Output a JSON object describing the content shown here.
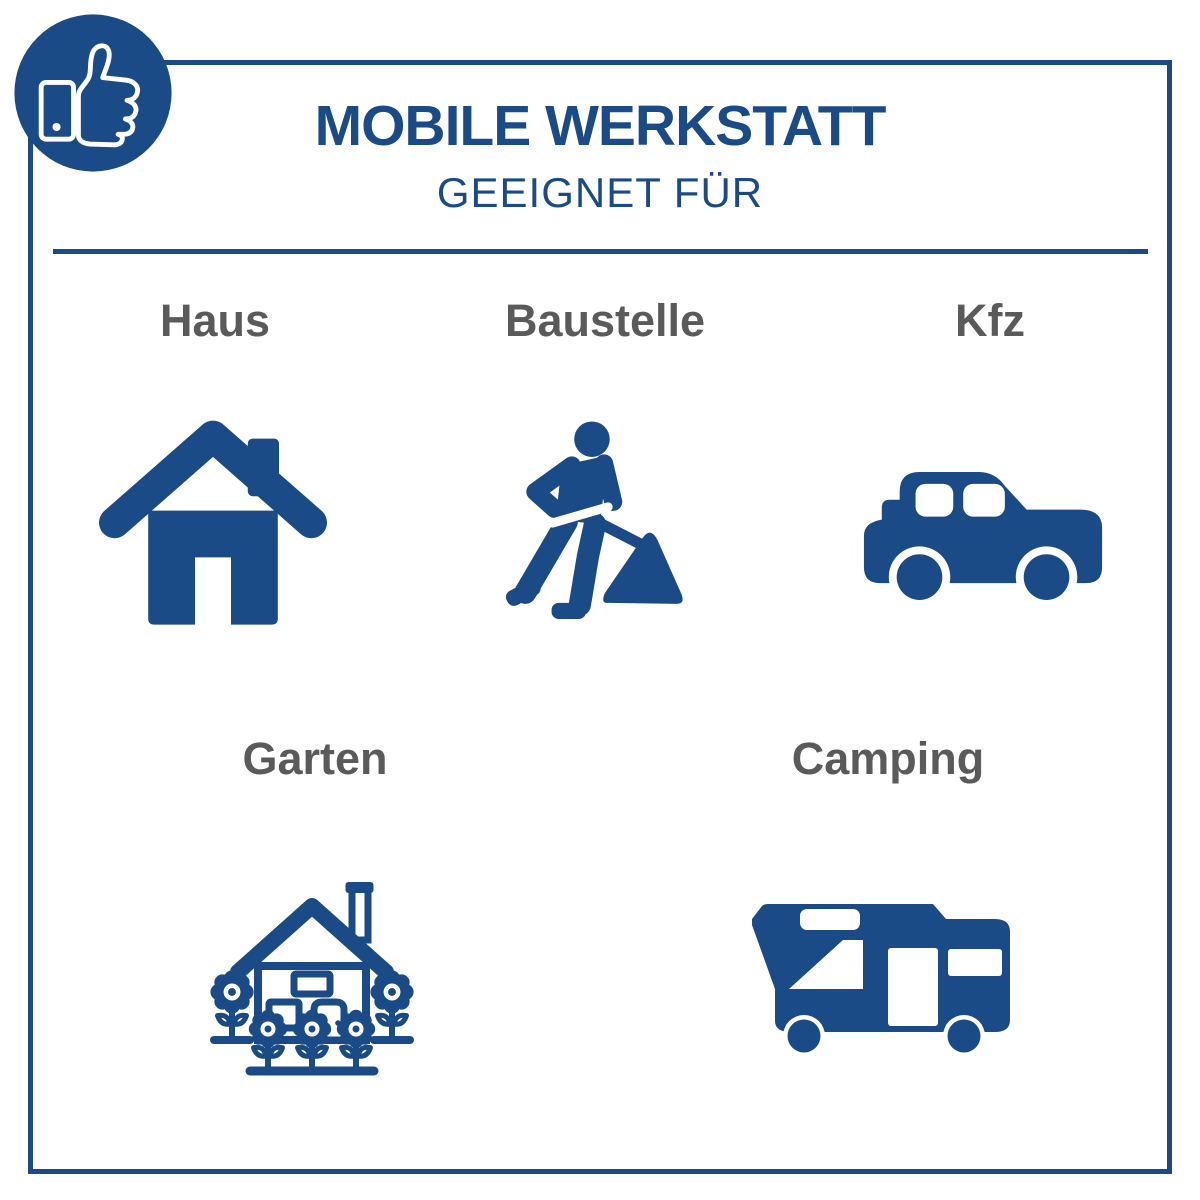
{
  "header": {
    "title": "MOBILE WERKSTATT",
    "subtitle": "GEEIGNET FÜR"
  },
  "badge": {
    "icon": "thumbs-up-phone-icon"
  },
  "colors": {
    "primary_blue": "#1A4B87",
    "label_gray": "#5A5A5A",
    "background": "#FFFFFF"
  },
  "categories": [
    {
      "id": "haus",
      "label": "Haus",
      "icon": "house-icon"
    },
    {
      "id": "baustelle",
      "label": "Baustelle",
      "icon": "construction-worker-icon"
    },
    {
      "id": "kfz",
      "label": "Kfz",
      "icon": "car-icon"
    },
    {
      "id": "garten",
      "label": "Garten",
      "icon": "garden-house-flowers-icon"
    },
    {
      "id": "camping",
      "label": "Camping",
      "icon": "camper-van-icon"
    }
  ]
}
